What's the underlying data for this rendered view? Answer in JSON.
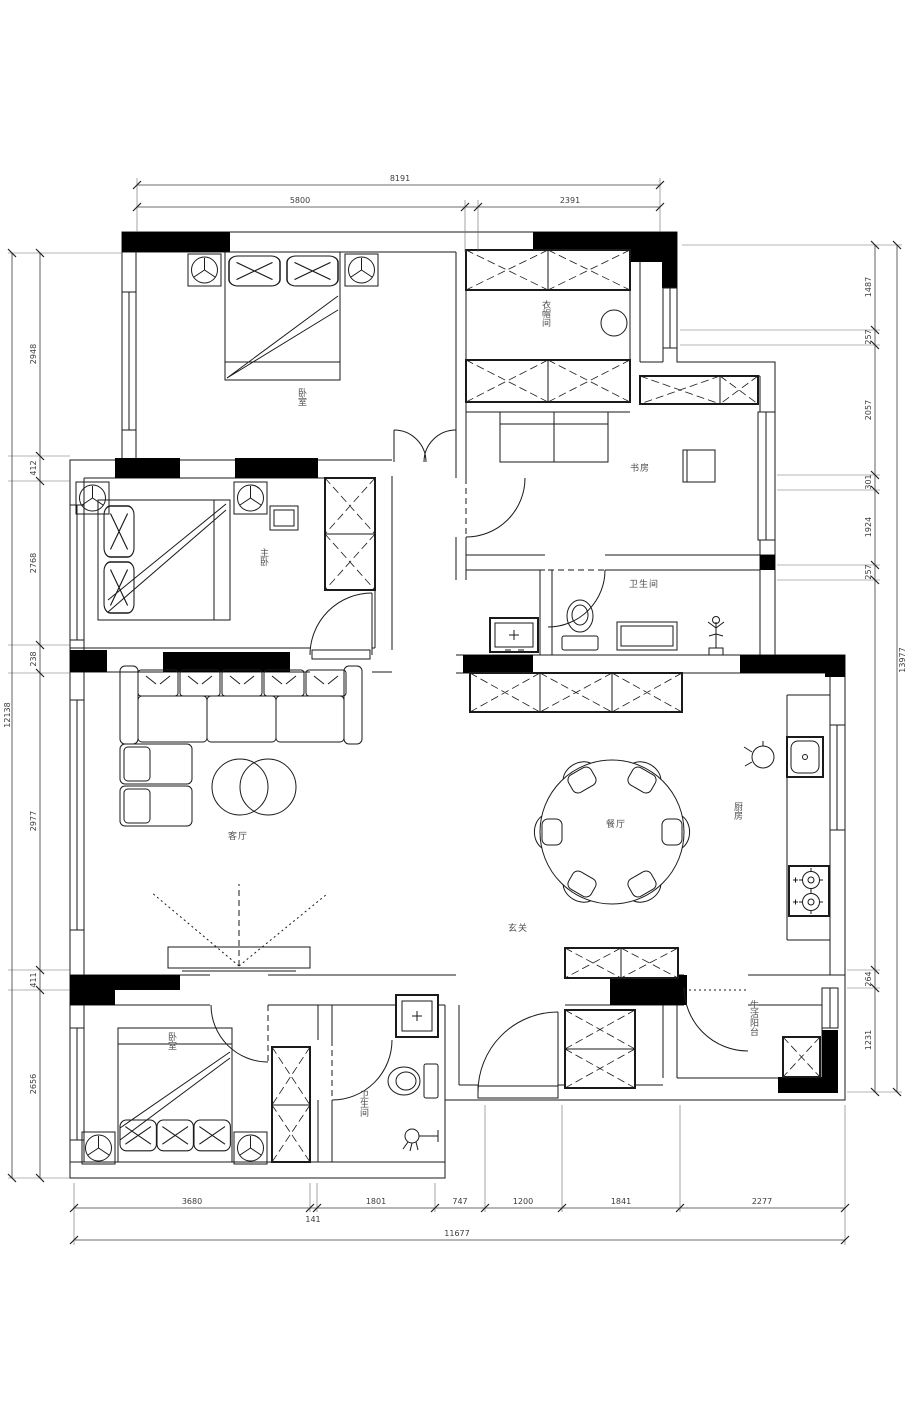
{
  "plan": {
    "room_labels": {
      "bedroom_top": "卧室",
      "cloakroom": "衣帽间",
      "study": "书房",
      "master_bedroom": "主卧",
      "bathroom_mid": "卫生间",
      "living_room": "客厅",
      "dining_room": "餐厅",
      "kitchen": "厨房",
      "foyer": "玄关",
      "balcony": "生活阳台",
      "bathroom_bottom": "卫生间",
      "bedroom_bottom": "卧室"
    },
    "dimensions": {
      "top": {
        "total": "8191",
        "segments": [
          "5800",
          "2391"
        ]
      },
      "bottom": {
        "segments": [
          "3680",
          "1801",
          "747",
          "1200",
          "1841",
          "2277"
        ],
        "inset": "141",
        "total": "11677"
      },
      "left": {
        "segments": [
          "2948",
          "412",
          "2768",
          "238",
          "2977",
          "411",
          "2656"
        ],
        "total": "12138"
      },
      "right": {
        "segments": [
          "1487",
          "257",
          "2057",
          "301",
          "1924",
          "257",
          "264",
          "1231"
        ],
        "total": "13977"
      }
    },
    "colors": {
      "line": "#1a1a1a",
      "dim_text": "#3c3c3c",
      "label_text": "#4e4e4e",
      "wall_fill": "#000000",
      "paper": "#ffffff"
    }
  }
}
